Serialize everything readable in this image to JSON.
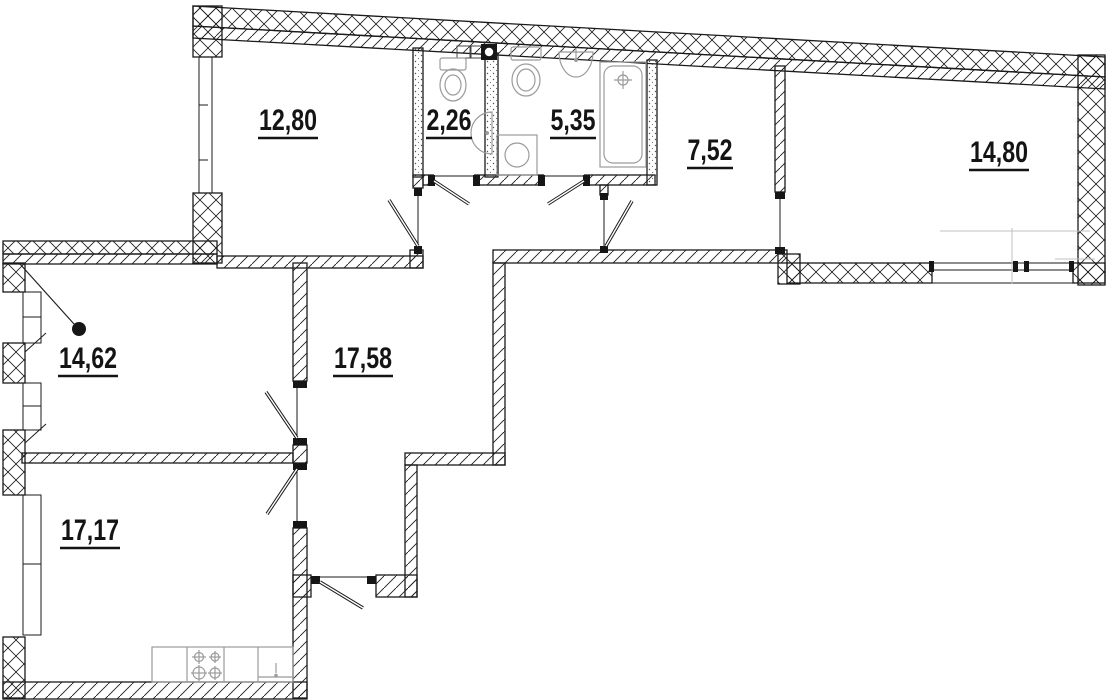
{
  "plan": {
    "type": "apartment-floor-plan",
    "background_color": "#ffffff",
    "wall_line_color": "#1b1b1b",
    "fixture_line_color": "#9b9b9b",
    "label_color": "#141414",
    "decimal_separator": ",",
    "rooms": [
      {
        "id": "room-12-80",
        "area": "12,80"
      },
      {
        "id": "wc-2-26",
        "area": "2,26"
      },
      {
        "id": "bathroom-5-35",
        "area": "5,35"
      },
      {
        "id": "corridor-7-52",
        "area": "7,52"
      },
      {
        "id": "room-14-80",
        "area": "14,80"
      },
      {
        "id": "room-14-62",
        "area": "14,62"
      },
      {
        "id": "hallway-17-58",
        "area": "17,58"
      },
      {
        "id": "kitchen-17-17",
        "area": "17,17"
      }
    ],
    "fixture_icons": [
      "toilet-icon",
      "cistern-icon",
      "vent-duct-icon",
      "corner-sink-icon",
      "washbasin-icon",
      "bathtub-icon",
      "washing-machine-icon",
      "stove-icon",
      "kitchen-sink-icon",
      "light-point-icon",
      "door-swing-icon",
      "window-icon"
    ]
  }
}
